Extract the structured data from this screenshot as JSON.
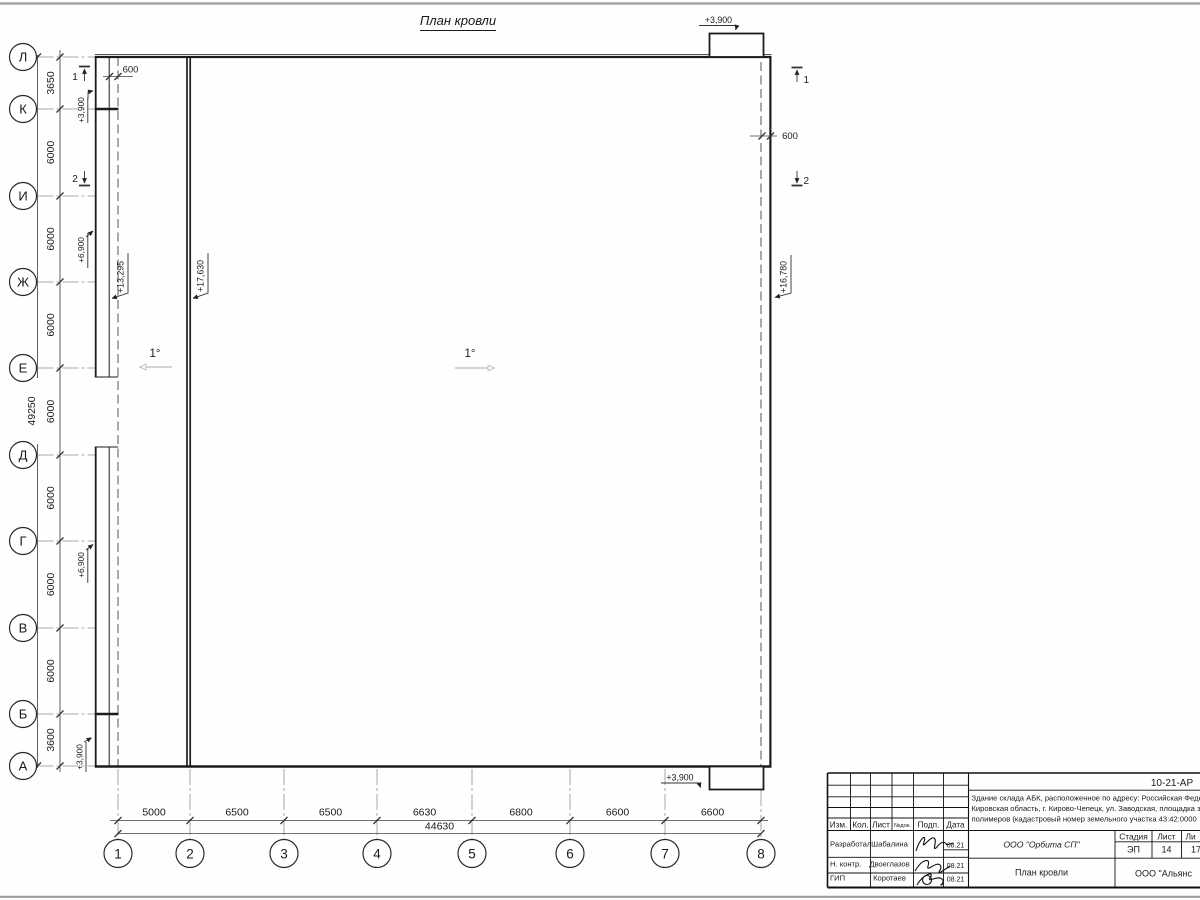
{
  "sheet": {
    "title": "План кровли",
    "slope_left": "1°",
    "slope_right": "1°",
    "offset_left": "600",
    "offset_right": "600",
    "section_mark_1": "1",
    "section_mark_2": "2",
    "elevations": {
      "canopy_top": "+3,900",
      "canopy_bottom": "+3,900",
      "parapet_k": "+3,900",
      "parapet_a": "+3,900",
      "wall_upper": "+6,900",
      "wall_lower": "+6,900",
      "abk_roof": "+13,295",
      "warehouse_roof_high": "+17,630",
      "warehouse_roof_low": "+16,780"
    }
  },
  "grid": {
    "rows": {
      "labels": [
        "Л",
        "К",
        "И",
        "Ж",
        "Е",
        "Д",
        "Г",
        "В",
        "Б",
        "А"
      ],
      "spacings_mm": [
        "3650",
        "6000",
        "6000",
        "6000",
        "6000",
        "6000",
        "6000",
        "6000",
        "3600"
      ],
      "total_mm": "49250"
    },
    "cols": {
      "labels": [
        "1",
        "2",
        "3",
        "4",
        "5",
        "6",
        "7",
        "8"
      ],
      "spacings_mm": [
        "5000",
        "6500",
        "6500",
        "6630",
        "6800",
        "6600",
        "6600"
      ],
      "total_mm": "44630"
    }
  },
  "titleblock": {
    "doc_number": "10-21-АР",
    "description_lines": [
      "Здание склада АБК, расположенное по адресу: Российская Феде",
      "Кировская область, г. Кирово-Чепецк, ул. Заводская, площадка з",
      "полимеров (кадастровый номер земельного участка 43:42:0000"
    ],
    "revision_header": [
      "Изм.",
      "Кол.",
      "Лист",
      "№док.",
      "Подп.",
      "Дата"
    ],
    "stage_header": [
      "Стадия",
      "Лист",
      "Ли"
    ],
    "stage_values": [
      "ЭП",
      "14",
      "17"
    ],
    "signature_rows": [
      {
        "role": "Разработал",
        "name": "Шабалина",
        "date": "08.21"
      },
      {
        "role": "Н. контр.",
        "name": "Двоеглазов",
        "date": "08.21"
      },
      {
        "role": "ГИП",
        "name": "Коротаев",
        "date": "08.21"
      }
    ],
    "design_company": "ООО \"Орбита СП\"",
    "sheet_name": "План кровли",
    "client_company": "ООО \"Альянс"
  }
}
